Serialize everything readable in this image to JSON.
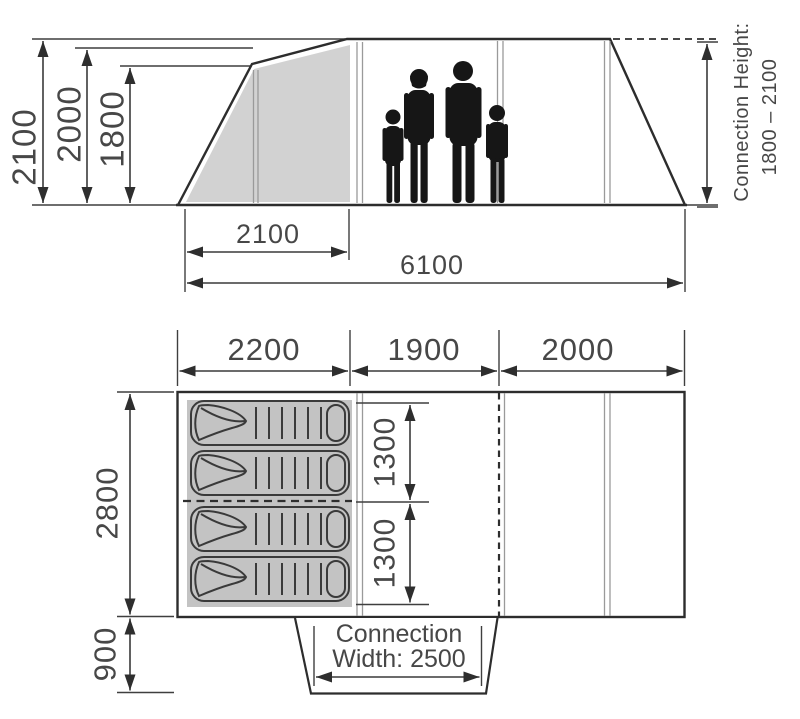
{
  "diagram_title": "Tent dimensions diagram (side elevation and floor plan)",
  "side_view": {
    "height_overall": "2100",
    "height_main": "2000",
    "height_front": "1800",
    "porch_length": "2100",
    "total_length": "6100",
    "connection_label": "Connection Height:",
    "connection_value": "1800 – 2100"
  },
  "floor_plan": {
    "section_sleeping": "2200",
    "section_living": "1900",
    "section_front": "2000",
    "width": "2800",
    "canopy_depth": "900",
    "berth_top": "1300",
    "berth_bottom": "1300",
    "connection_line1": "Connection",
    "connection_line2": "Width: 2500"
  },
  "colors": {
    "outline": "#2d2d2d",
    "thin_line": "#9a9a9a",
    "porch_fill": "#d2d2d2",
    "sleeping_fill": "#c3c3c3",
    "silhouette": "#161616",
    "text": "#474747"
  }
}
